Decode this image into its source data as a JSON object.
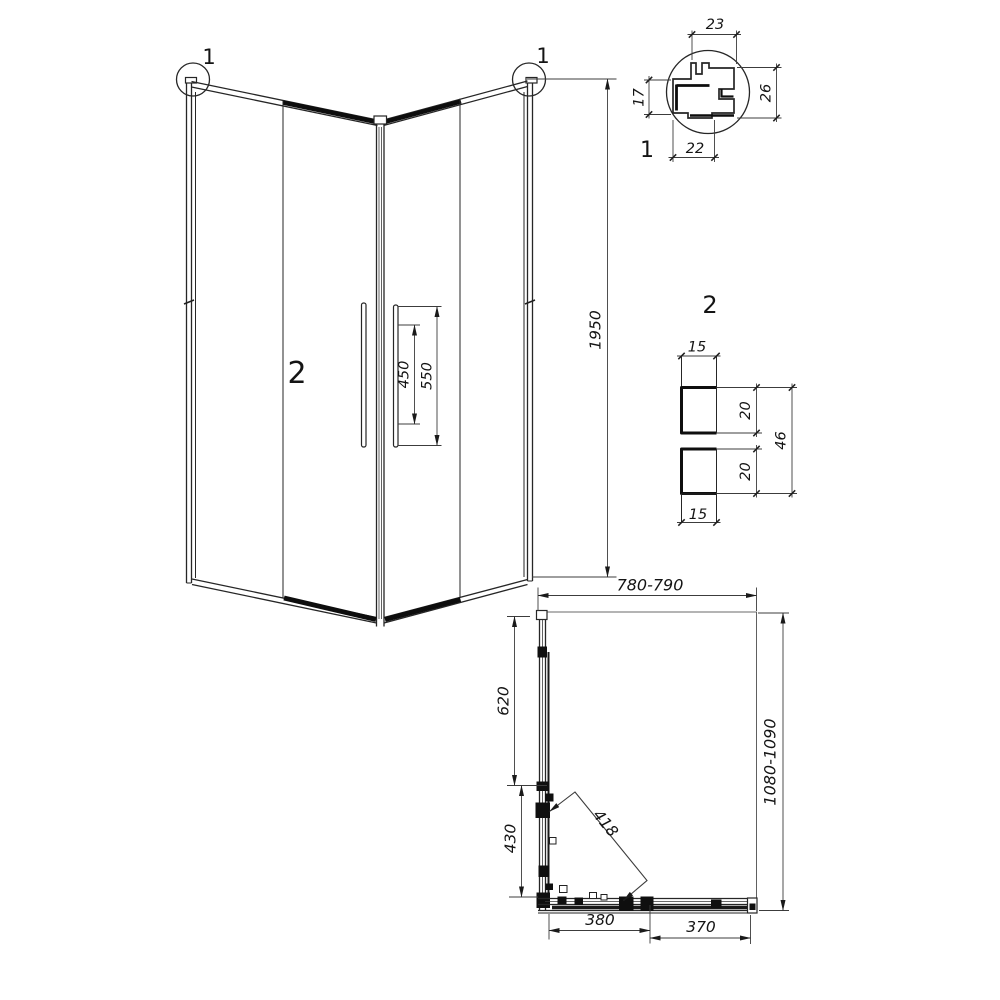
{
  "drawing_type": "shower-enclosure-technical-drawing",
  "colors": {
    "line": "#262626",
    "dim": "#3c3c3c",
    "fill_block": "#0f0f0f",
    "background": "#ffffff"
  },
  "elevation": {
    "callout_left": "1",
    "callout_right": "1",
    "panel_label": "2",
    "dims": {
      "height": "1950",
      "handle_inner": "450",
      "handle_outer": "550"
    }
  },
  "detail_1": {
    "label": "1",
    "dims": {
      "top": "23",
      "right": "26",
      "left": "17",
      "bottom": "22"
    }
  },
  "detail_2": {
    "label": "2",
    "dims": {
      "top": "15",
      "upper": "20",
      "lower": "20",
      "overall": "46",
      "bottom": "15"
    }
  },
  "plan": {
    "dims": {
      "width": "780-790",
      "depth": "1080-1090",
      "side_upper": "620",
      "side_lower": "430",
      "diagonal": "418",
      "bottom_left": "380",
      "bottom_right": "370"
    }
  }
}
